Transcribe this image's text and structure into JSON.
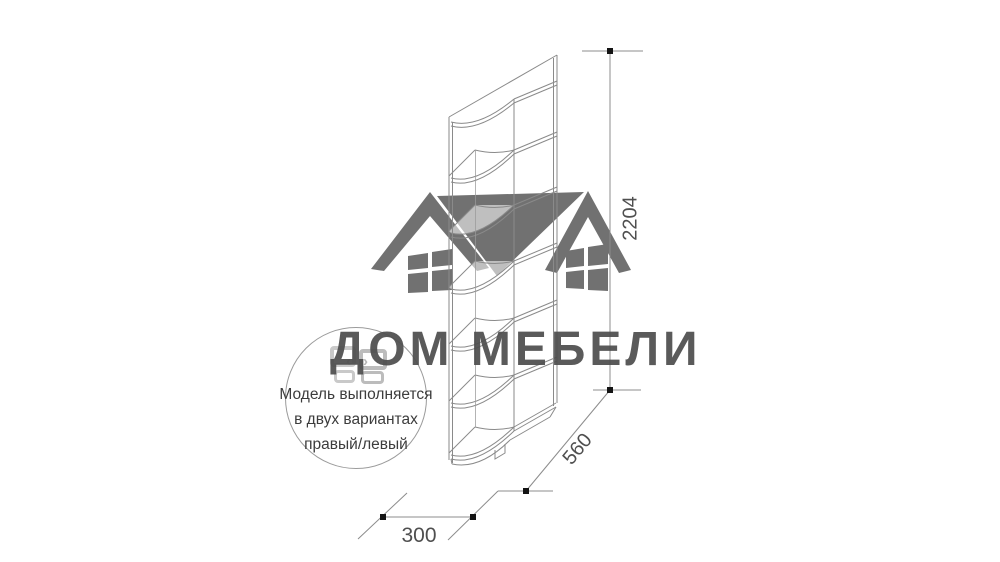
{
  "brand": {
    "text": "ДОМ МЕБЕЛИ",
    "text_color": "#4d4d4d",
    "logo_icon": "window-squares-with-arrows",
    "logo_color_light": "#c9c9c9",
    "logo_color_mid": "#bcbcbc"
  },
  "watermark": {
    "description": "two-house-roofs-silhouette",
    "color": "#717171"
  },
  "note_circle": {
    "line1": "Модель выполняется",
    "line2": "в двух вариантах",
    "line3": "правый/левый",
    "text_color": "#3c3c3c",
    "border_color": "#9b9b9b"
  },
  "dimensions": {
    "height": "2204",
    "depth": "560",
    "width": "300",
    "text_color": "#4f4f4f",
    "line_color": "#8c8c8c",
    "marker_color": "#141414"
  },
  "drawing": {
    "subject": "corner-end-shelf-isometric",
    "line_color": "#8a8a8a",
    "shelf_levels": 6
  },
  "logo_arrows": {
    "left": "‹",
    "right": "›"
  }
}
